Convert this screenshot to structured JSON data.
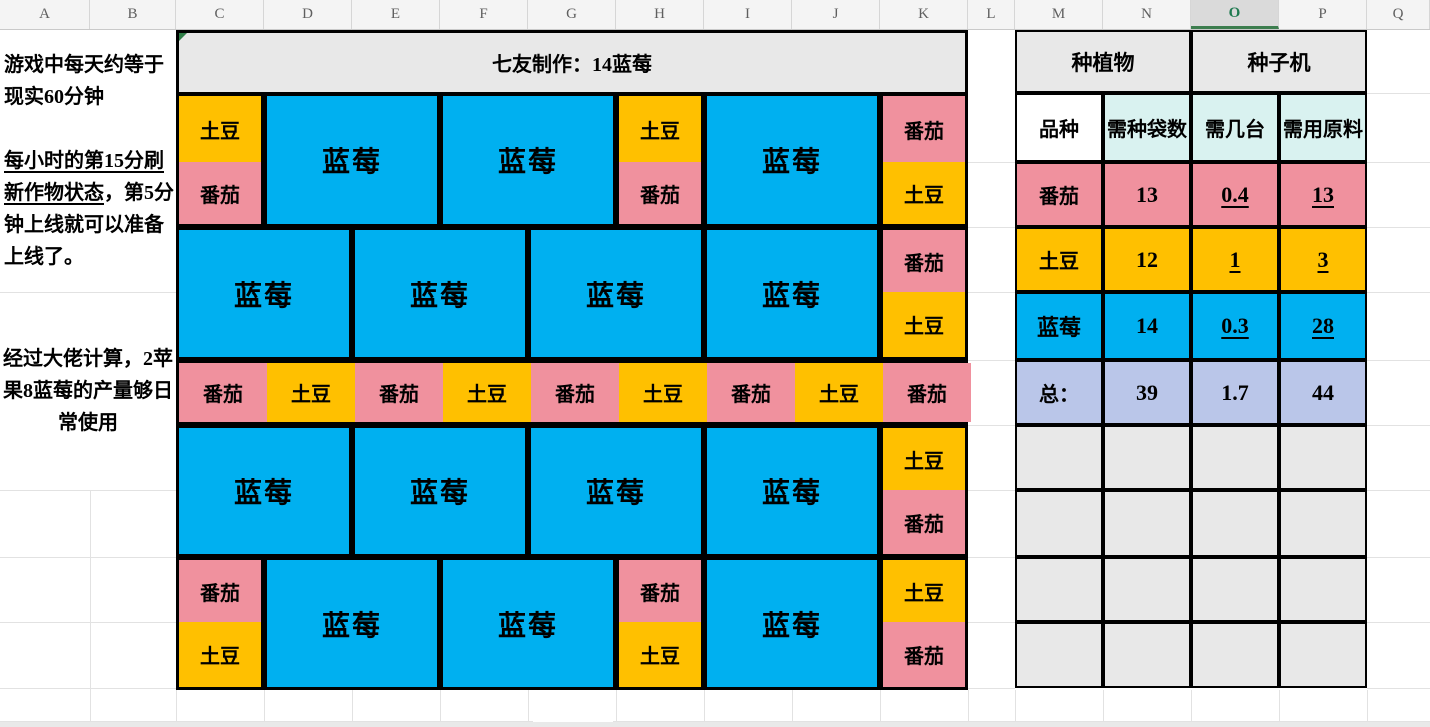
{
  "app": {
    "columns": [
      "A",
      "B",
      "C",
      "D",
      "E",
      "F",
      "G",
      "H",
      "I",
      "J",
      "K",
      "L",
      "M",
      "N",
      "O",
      "P",
      "Q"
    ],
    "selected_column": "O"
  },
  "notes": {
    "para1": "游戏中每天约等于现实60分钟",
    "para2_underlined": "每小时的第15分刷新作物状态",
    "para2_rest": "，第5分钟上线就可以准备上线了。",
    "para3": "经过大佬计算，2苹果8蓝莓的产量够日常使用"
  },
  "farm": {
    "title": "七友制作：14蓝莓",
    "labels": {
      "blueberry": "蓝莓",
      "potato": "土豆",
      "tomato": "番茄"
    },
    "colors": {
      "blueberry": "#00B0F0",
      "potato": "#FFC000",
      "tomato": "#F0919E"
    },
    "blocks": [
      {
        "kind": "stack",
        "col": 0,
        "row": 0,
        "crops": [
          "potato",
          "tomato"
        ]
      },
      {
        "kind": "merge",
        "col": 1,
        "span": 2,
        "row": 0,
        "crop": "blueberry"
      },
      {
        "kind": "merge",
        "col": 3,
        "span": 2,
        "row": 0,
        "crop": "blueberry"
      },
      {
        "kind": "stack",
        "col": 5,
        "row": 0,
        "crops": [
          "potato",
          "tomato"
        ]
      },
      {
        "kind": "merge",
        "col": 6,
        "span": 2,
        "row": 0,
        "crop": "blueberry"
      },
      {
        "kind": "stack",
        "col": 8,
        "row": 0,
        "crops": [
          "tomato",
          "potato"
        ]
      },
      {
        "kind": "merge",
        "col": 0,
        "span": 2,
        "row": 2,
        "crop": "blueberry"
      },
      {
        "kind": "merge",
        "col": 2,
        "span": 2,
        "row": 2,
        "crop": "blueberry"
      },
      {
        "kind": "merge",
        "col": 4,
        "span": 2,
        "row": 2,
        "crop": "blueberry"
      },
      {
        "kind": "merge",
        "col": 6,
        "span": 2,
        "row": 2,
        "crop": "blueberry"
      },
      {
        "kind": "stack",
        "col": 8,
        "row": 2,
        "crops": [
          "tomato",
          "potato"
        ]
      },
      {
        "kind": "strip",
        "col": 0,
        "span": 9,
        "row": 4,
        "crops": [
          "tomato",
          "potato",
          "tomato",
          "potato",
          "tomato",
          "potato",
          "tomato",
          "potato",
          "tomato"
        ]
      },
      {
        "kind": "merge",
        "col": 0,
        "span": 2,
        "row": 5,
        "crop": "blueberry"
      },
      {
        "kind": "merge",
        "col": 2,
        "span": 2,
        "row": 5,
        "crop": "blueberry"
      },
      {
        "kind": "merge",
        "col": 4,
        "span": 2,
        "row": 5,
        "crop": "blueberry"
      },
      {
        "kind": "merge",
        "col": 6,
        "span": 2,
        "row": 5,
        "crop": "blueberry"
      },
      {
        "kind": "stack",
        "col": 8,
        "row": 5,
        "crops": [
          "potato",
          "tomato"
        ]
      },
      {
        "kind": "stack",
        "col": 0,
        "row": 7,
        "crops": [
          "tomato",
          "potato"
        ]
      },
      {
        "kind": "merge",
        "col": 1,
        "span": 2,
        "row": 7,
        "crop": "blueberry"
      },
      {
        "kind": "merge",
        "col": 3,
        "span": 2,
        "row": 7,
        "crop": "blueberry"
      },
      {
        "kind": "stack",
        "col": 5,
        "row": 7,
        "crops": [
          "tomato",
          "potato"
        ]
      },
      {
        "kind": "merge",
        "col": 6,
        "span": 2,
        "row": 7,
        "crop": "blueberry"
      },
      {
        "kind": "stack",
        "col": 8,
        "row": 7,
        "crops": [
          "potato",
          "tomato"
        ]
      }
    ]
  },
  "table": {
    "group_headers": [
      {
        "label": "种植物"
      },
      {
        "label": "种子机"
      }
    ],
    "col_headers": [
      "品种",
      "需种袋数",
      "需几台",
      "需用原料"
    ],
    "fills": {
      "group_header": "#E8E8E8",
      "col_header_first": "#FFFFFF",
      "col_header": "#D9F2F0",
      "total_row": "#BAC6E9",
      "empty_row": "#E8E8E8"
    },
    "rows": [
      {
        "name": "番茄",
        "bags": "13",
        "machines": "0.4",
        "materials": "13",
        "underline": true,
        "color_key": "tomato"
      },
      {
        "name": "土豆",
        "bags": "12",
        "machines": "1",
        "materials": "3",
        "underline": true,
        "color_key": "potato"
      },
      {
        "name": "蓝莓",
        "bags": "14",
        "machines": "0.3",
        "materials": "28",
        "underline": true,
        "color_key": "blueberry"
      },
      {
        "name": "总：",
        "bags": "39",
        "machines": "1.7",
        "materials": "44",
        "underline": false,
        "color_key": "total"
      }
    ],
    "empty_row_count": 4
  }
}
